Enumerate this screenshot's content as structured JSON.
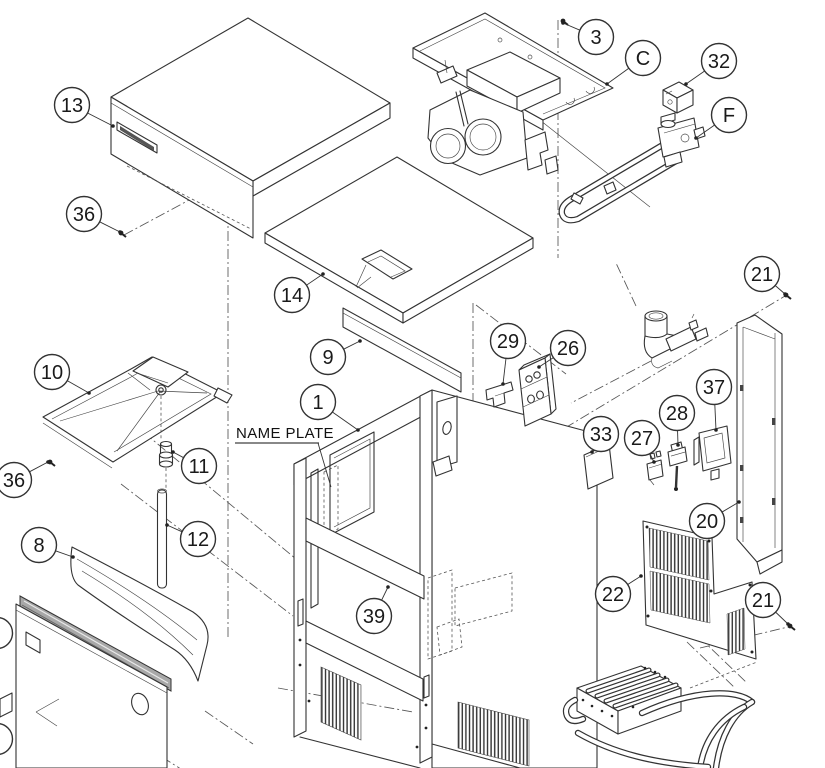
{
  "diagram": {
    "type": "exploded-view-parts-diagram",
    "name_plate_label": "NAME PLATE",
    "callouts": [
      {
        "id": "13",
        "label": "13",
        "cx": 72,
        "cy": 105,
        "lx": 113,
        "ly": 126
      },
      {
        "id": "36-top",
        "label": "36",
        "cx": 84,
        "cy": 214,
        "lx": 120,
        "ly": 232
      },
      {
        "id": "3",
        "label": "3",
        "cx": 596,
        "cy": 37,
        "lx": 563,
        "ly": 23
      },
      {
        "id": "C",
        "label": "C",
        "cx": 643,
        "cy": 58,
        "lx": 607,
        "ly": 84
      },
      {
        "id": "32",
        "label": "32",
        "cx": 719,
        "cy": 61,
        "lx": 686,
        "ly": 84
      },
      {
        "id": "F",
        "label": "F",
        "cx": 729,
        "cy": 115,
        "lx": 696,
        "ly": 138
      },
      {
        "id": "14",
        "label": "14",
        "cx": 292,
        "cy": 295,
        "lx": 323,
        "ly": 274
      },
      {
        "id": "9",
        "label": "9",
        "cx": 328,
        "cy": 357,
        "lx": 360,
        "ly": 341
      },
      {
        "id": "1",
        "label": "1",
        "cx": 318,
        "cy": 402,
        "lx": 358,
        "ly": 430
      },
      {
        "id": "29",
        "label": "29",
        "cx": 508,
        "cy": 341,
        "lx": 503,
        "ly": 384
      },
      {
        "id": "26",
        "label": "26",
        "cx": 568,
        "cy": 348,
        "lx": 539,
        "ly": 367
      },
      {
        "id": "21-top",
        "label": "21",
        "cx": 762,
        "cy": 274,
        "lx": 785,
        "ly": 294
      },
      {
        "id": "10",
        "label": "10",
        "cx": 52,
        "cy": 372,
        "lx": 89,
        "ly": 393
      },
      {
        "id": "11",
        "label": "11",
        "cx": 199,
        "cy": 466,
        "lx": 173,
        "ly": 452
      },
      {
        "id": "36-left",
        "label": "36",
        "cx": 14,
        "cy": 480,
        "lx": 48,
        "ly": 462
      },
      {
        "id": "12",
        "label": "12",
        "cx": 198,
        "cy": 539,
        "lx": 167,
        "ly": 525
      },
      {
        "id": "8",
        "label": "8",
        "cx": 39,
        "cy": 545,
        "lx": 73,
        "ly": 557
      },
      {
        "id": "33",
        "label": "33",
        "cx": 601,
        "cy": 434,
        "lx": 592,
        "ly": 452
      },
      {
        "id": "27",
        "label": "27",
        "cx": 642,
        "cy": 438,
        "lx": 654,
        "ly": 462
      },
      {
        "id": "28",
        "label": "28",
        "cx": 677,
        "cy": 413,
        "lx": 678,
        "ly": 445
      },
      {
        "id": "37",
        "label": "37",
        "cx": 714,
        "cy": 387,
        "lx": 716,
        "ly": 430
      },
      {
        "id": "20",
        "label": "20",
        "cx": 707,
        "cy": 521,
        "lx": 739,
        "ly": 502
      },
      {
        "id": "22",
        "label": "22",
        "cx": 613,
        "cy": 594,
        "lx": 641,
        "ly": 576
      },
      {
        "id": "21-bottom",
        "label": "21",
        "cx": 763,
        "cy": 600,
        "lx": 788,
        "ly": 624
      },
      {
        "id": "39",
        "label": "39",
        "cx": 374,
        "cy": 616,
        "lx": 388,
        "ly": 587
      }
    ],
    "screws": [
      [
        563,
        21
      ],
      [
        786,
        295
      ],
      [
        790,
        626
      ],
      [
        121,
        233
      ],
      [
        50,
        462
      ]
    ],
    "cut_callouts": [
      [
        -3,
        633
      ],
      [
        -3,
        739
      ]
    ]
  }
}
